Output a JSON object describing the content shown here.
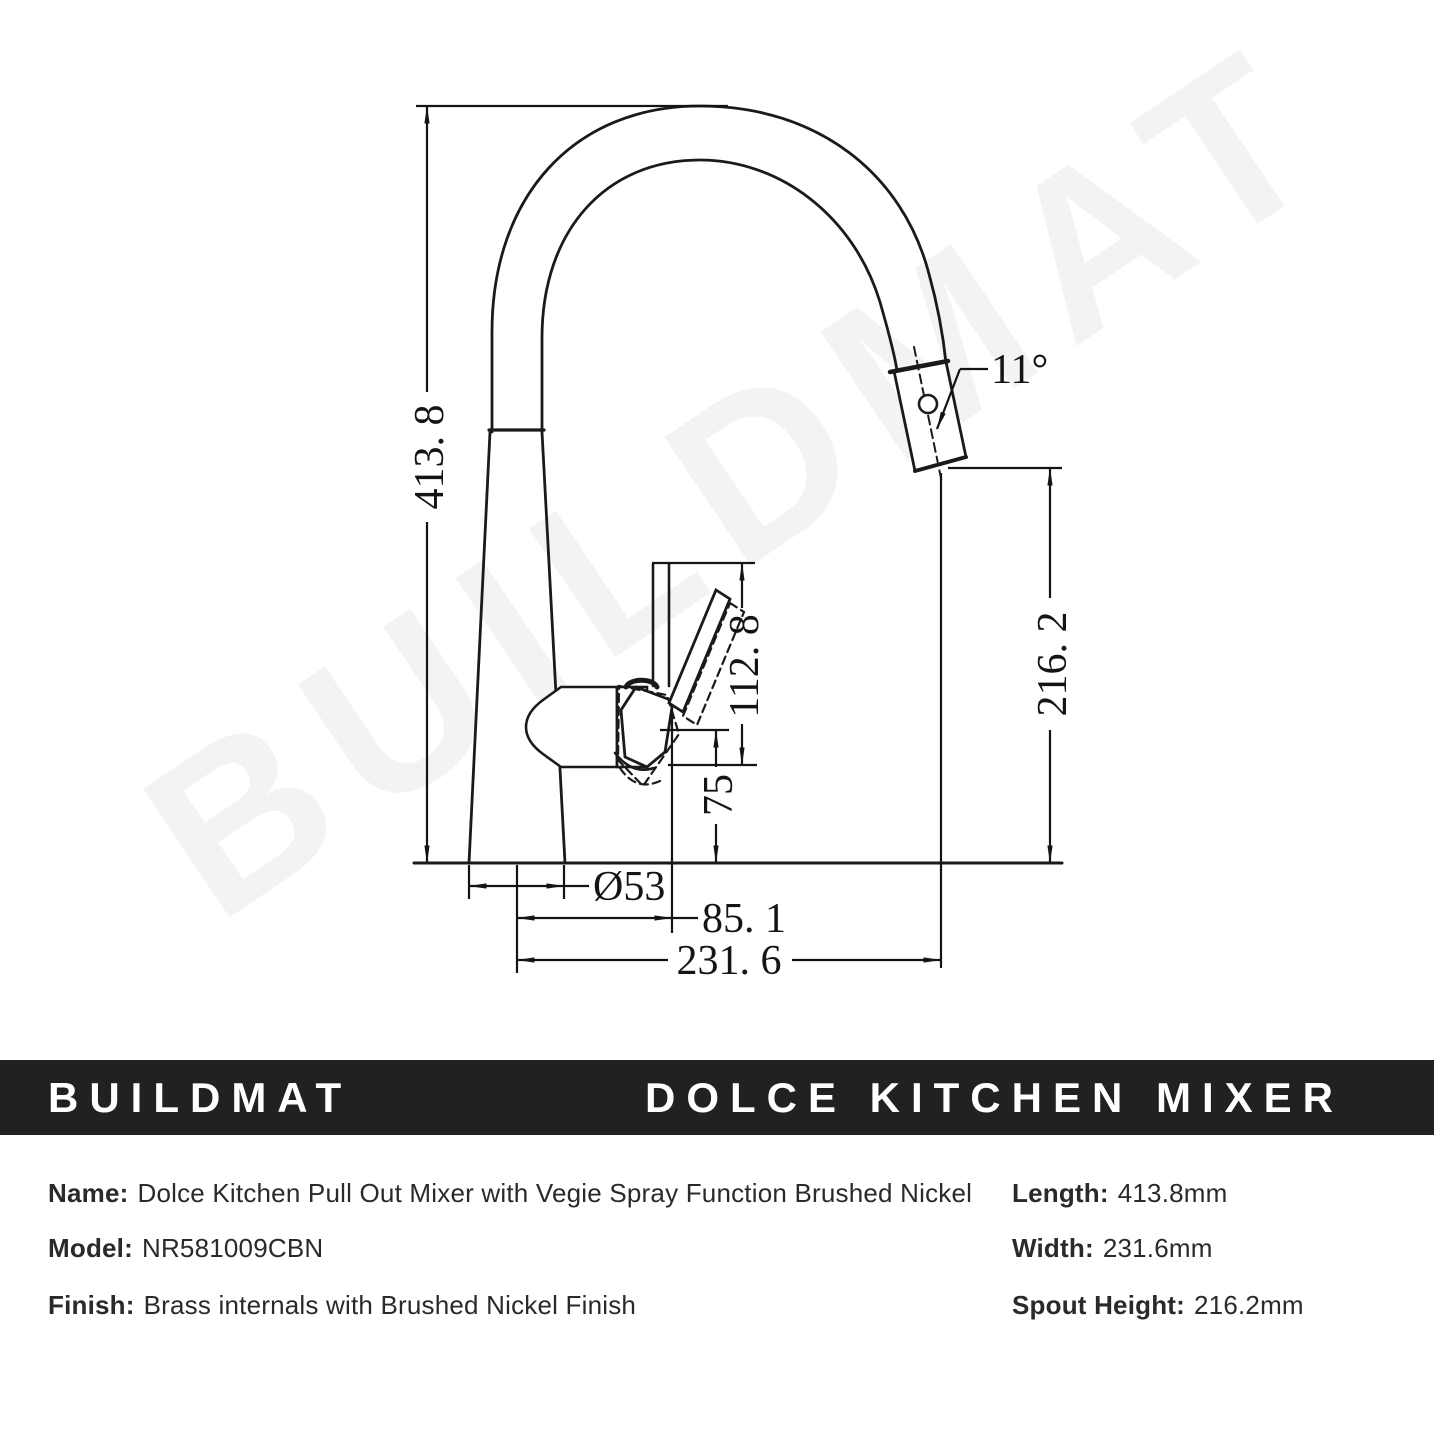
{
  "watermark": "BUILDMAT",
  "banner": {
    "brand": "BUILDMAT",
    "title": "DOLCE KITCHEN MIXER"
  },
  "drawing": {
    "dim_total_height": "413. 8",
    "dim_spout_height": "216. 2",
    "dim_handle_height": "112. 8",
    "dim_body_height": "75",
    "dim_base_diameter": "Ø53",
    "dim_handle_projection": "85. 1",
    "dim_total_width": "231. 6",
    "dim_spray_angle": "11°"
  },
  "specs": {
    "rows": [
      {
        "label": "Name:",
        "value": "Dolce Kitchen Pull Out Mixer with Vegie Spray Function Brushed Nickel"
      },
      {
        "label": "Model:",
        "value": "NR581009CBN"
      },
      {
        "label": "Finish:",
        "value": "Brass internals with Brushed Nickel Finish"
      }
    ],
    "metrics": [
      {
        "label": "Length:",
        "value": "413.8mm"
      },
      {
        "label": "Width:",
        "value": "231.6mm"
      },
      {
        "label": "Spout Height:",
        "value": "216.2mm"
      }
    ]
  }
}
